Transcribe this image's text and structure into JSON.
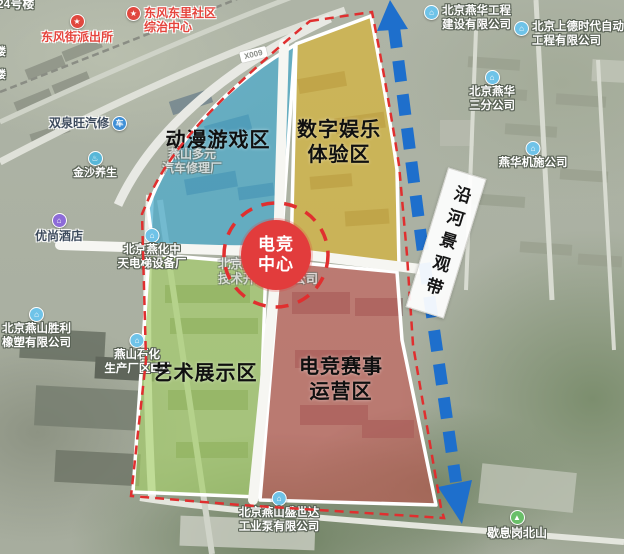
{
  "colors": {
    "boundary": "#e02f2f",
    "corridor_arrow": "#1e6fcc",
    "hub_circle": "#e23c3c",
    "zone_blue": "#35a9d4",
    "zone_yellow": "#ddb52a",
    "zone_green": "#a4d166",
    "zone_red": "#c94f4a"
  },
  "hub": {
    "lines": [
      "电竞",
      "中心"
    ]
  },
  "corridor": {
    "label": "沿河景观带"
  },
  "road_badge": "X009",
  "zones": [
    {
      "name": "zone-anime-gaming",
      "label_lines": [
        "动漫游戏区"
      ],
      "color": "#35a9d4",
      "opacity": 0.6,
      "label_x": 218,
      "label_y": 141
    },
    {
      "name": "zone-digital-entertainment",
      "label_lines": [
        "数字娱乐",
        "体验区"
      ],
      "color": "#ddb52a",
      "opacity": 0.62,
      "label_x": 339,
      "label_y": 143
    },
    {
      "name": "zone-art-exhibition",
      "label_lines": [
        "艺术展示区"
      ],
      "color": "#a4d166",
      "opacity": 0.62,
      "label_x": 205,
      "label_y": 374
    },
    {
      "name": "zone-esports-events",
      "label_lines": [
        "电竞赛事",
        "运营区"
      ],
      "color": "#c94f4a",
      "opacity": 0.55,
      "label_x": 341,
      "label_y": 380
    }
  ],
  "pois": [
    {
      "name": "label-building-24",
      "x": -3,
      "y": -3,
      "anchor": "left",
      "style": "white",
      "size": 12,
      "lines": [
        "24号楼"
      ]
    },
    {
      "name": "label-partial-building-1",
      "x": -5,
      "y": 46,
      "anchor": "left",
      "style": "white",
      "size": 11,
      "lines": [
        "楼"
      ]
    },
    {
      "name": "label-partial-building-2",
      "x": -5,
      "y": 69,
      "anchor": "left",
      "style": "white",
      "size": 11,
      "lines": [
        "楼"
      ]
    },
    {
      "name": "poi-dongfeng-police-station",
      "x": 77,
      "y": 14,
      "anchor": "center",
      "style": "red",
      "size": 12,
      "lines": [
        "东风街派出所"
      ],
      "icon": {
        "name": "police-badge-icon",
        "glyph": "★",
        "bg": "#e0483f",
        "side": "top"
      }
    },
    {
      "name": "poi-dongfeng-dongli-community-center",
      "x": 126,
      "y": 6,
      "anchor": "left",
      "style": "red",
      "size": 12,
      "lines": [
        "东风东里社区",
        "综治中心"
      ],
      "icon": {
        "name": "star-icon",
        "glyph": "★",
        "bg": "#e0483f",
        "side": "left"
      }
    },
    {
      "name": "poi-shuangquanwang-auto-repair",
      "x": 88,
      "y": 116,
      "anchor": "center",
      "style": "dark",
      "size": 12,
      "lines": [
        "双泉旺汽修"
      ],
      "icon": {
        "name": "car-icon",
        "glyph": "车",
        "bg": "#3f8fd6",
        "side": "right"
      }
    },
    {
      "name": "poi-jinsha-health",
      "x": 95,
      "y": 151,
      "anchor": "center",
      "style": "white",
      "size": 11,
      "lines": [
        "金沙养生"
      ],
      "icon": {
        "name": "spa-icon",
        "glyph": "♨",
        "bg": "#58b7d8",
        "side": "top"
      }
    },
    {
      "name": "poi-youshang-hotel",
      "x": 59,
      "y": 213,
      "anchor": "center",
      "style": "dark",
      "size": 12,
      "lines": [
        "优尚酒店"
      ],
      "icon": {
        "name": "hotel-bed-icon",
        "glyph": "⌂",
        "bg": "#8d6bd8",
        "side": "top"
      }
    },
    {
      "name": "poi-yanhua-zhongtian-equipment",
      "x": 152,
      "y": 228,
      "anchor": "center",
      "style": "white",
      "size": 11.5,
      "lines": [
        "北京燕化中",
        "天电梯设备厂"
      ],
      "icon": {
        "name": "company-icon",
        "glyph": "⌂",
        "bg": "#6fc3e8",
        "side": "top"
      }
    },
    {
      "name": "poi-yanshan-duoyuan-auto-repair",
      "x": 192,
      "y": 147,
      "anchor": "center",
      "style": "faint",
      "size": 12,
      "lines": [
        "燕山多元",
        "汽车修理厂"
      ]
    },
    {
      "name": "label-yanshan-tech-dev",
      "x": 218,
      "y": 257,
      "anchor": "left",
      "style": "faint",
      "size": 12.5,
      "lines": [
        "北京燕山",
        "技术开发有限公司"
      ]
    },
    {
      "name": "poi-yanshan-shengli-rubber",
      "x": 2,
      "y": 307,
      "anchor": "left",
      "style": "white",
      "size": 11.5,
      "lines": [
        "北京燕山胜利",
        "橡塑有限公司"
      ],
      "icon": {
        "name": "company-icon",
        "glyph": "⌂",
        "bg": "#6fc3e8",
        "side": "top"
      }
    },
    {
      "name": "poi-yanshan-shihua-plant",
      "x": 137,
      "y": 333,
      "anchor": "center",
      "style": "white",
      "size": 11.5,
      "lines": [
        "燕山石化",
        "生产厂区E区"
      ],
      "icon": {
        "name": "company-icon",
        "glyph": "⌂",
        "bg": "#6fc3e8",
        "side": "top"
      }
    },
    {
      "name": "poi-yanshan-shengshida-pump",
      "x": 279,
      "y": 491,
      "anchor": "center",
      "style": "white",
      "size": 11.5,
      "lines": [
        "北京燕山盛世达",
        "工业泵有限公司"
      ],
      "icon": {
        "name": "company-icon",
        "glyph": "⌂",
        "bg": "#6fc3e8",
        "side": "top"
      }
    },
    {
      "name": "poi-xiexigang-north-hill",
      "x": 517,
      "y": 510,
      "anchor": "center",
      "style": "white",
      "size": 12,
      "lines": [
        "歇息岗北山"
      ],
      "icon": {
        "name": "mountain-icon",
        "glyph": "▲",
        "bg": "#6abf69",
        "side": "top"
      }
    },
    {
      "name": "poi-yanhua-jishi-company",
      "x": 533,
      "y": 141,
      "anchor": "center",
      "style": "white",
      "size": 11.5,
      "lines": [
        "燕华机施公司"
      ],
      "icon": {
        "name": "company-icon",
        "glyph": "⌂",
        "bg": "#6fc3e8",
        "side": "top"
      }
    },
    {
      "name": "poi-yanhua-third-branch",
      "x": 492,
      "y": 70,
      "anchor": "center",
      "style": "white",
      "size": 11.5,
      "lines": [
        "北京燕华",
        "三分公司"
      ],
      "icon": {
        "name": "company-icon",
        "glyph": "⌂",
        "bg": "#6fc3e8",
        "side": "top"
      }
    },
    {
      "name": "poi-yanhua-engineering",
      "x": 424,
      "y": 5,
      "anchor": "left",
      "style": "white",
      "size": 11.5,
      "lines": [
        "北京燕华工程",
        "建设有限公司"
      ],
      "icon": {
        "name": "company-icon",
        "glyph": "⌂",
        "bg": "#6fc3e8",
        "side": "left"
      }
    },
    {
      "name": "poi-shangde-automation",
      "x": 514,
      "y": 21,
      "anchor": "left",
      "style": "white",
      "size": 11.5,
      "lines": [
        "北京上德时代自动化",
        "工程有限公司"
      ],
      "icon": {
        "name": "company-icon",
        "glyph": "⌂",
        "bg": "#6fc3e8",
        "side": "left"
      }
    }
  ]
}
